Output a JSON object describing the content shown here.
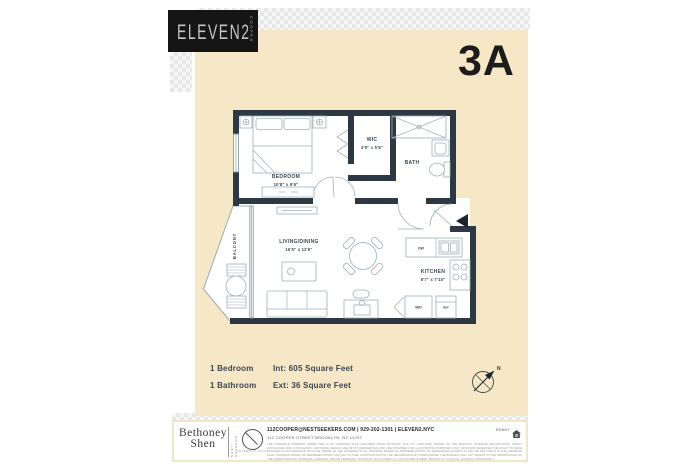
{
  "header": {
    "brand": "ELEVEN2",
    "brand_sub": "COOPER",
    "unit": "3A"
  },
  "floorplan": {
    "rooms": {
      "bedroom": {
        "name": "BEDROOM",
        "dims": "10'8\" x 9'6\""
      },
      "wic": {
        "name": "WIC",
        "dims": "3'9\" x 5'8\""
      },
      "bath": {
        "name": "BATH"
      },
      "living": {
        "name": "LIVING/DINING",
        "dims": "16'5\" x 12'6\""
      },
      "kitchen": {
        "name": "KITCHEN",
        "dims": "8'7\" x 7'10\""
      },
      "balcony": {
        "name": "BALCONY"
      }
    },
    "labels": {
      "dw": "DW",
      "wd": "W/D",
      "ref": "REF"
    },
    "compass_north": "N"
  },
  "summary": {
    "bedrooms": "1 Bedroom",
    "bathrooms": "1 Bathroom",
    "interior": "Int:  605 Square Feet",
    "exterior": "Ext:  36 Square Feet"
  },
  "footer": {
    "broker_line1": "Bethoney",
    "broker_line2": "Shen",
    "agency": "NEST SEEKERS",
    "agency_sub": "INTERNATIONAL",
    "contact": "112COOPER@NESTSEEKERS.COM   |   929-202-1301   |   ELEVEN2.NYC",
    "address": "112 COOPER STREET  BROOKLYN, NY 11207",
    "rebny": "REBNY",
    "disclaimer": "THE COMPLETE OFFERING TERMS ARE IN AN OFFERING PLAN AVAILABLE FROM SPONSOR. FILE NO. CD16-0348. IMAGES OF THE BUILDING, INTERIOR DECORATIONS, FINISH, APPLIANCES AND FURNISHINGS CONTAINED HEREIN ARE ARTIST RENDERINGS AND ARE PROVIDED FOR ILLUSTRATIVE PURPOSES ONLY. SPONSOR RESERVES THE RIGHT TO MAKE CHANGES IN ACCORDANCE WITH THE TERMS OF THE OFFERING PLAN. SPONSOR MAKES NO REPRESENTATION OR WARRANTIES EXCEPT AS MAY BE SET FORTH IN THE OFFERING PLAN. SPONSOR MAKES NO REPRESENTATION THAT ANY FUTURE CONSTRUCTION IN THE NEIGHBORHOOD SURROUNDING THE BUILDING WILL NOT RESULT IN THE OBSTRUCTION OF THE VIEWS FROM ANY WINDOWS, GARDENS, AND/OR TERRACES. SPONSOR: 112 COOPER LLC, 112 COOPER STREET, BROOKLYN, NY. EQUAL HOUSING OPPORTUNITY."
  },
  "colors": {
    "page_bg": "#f6e8c6",
    "wall": "#2c3844",
    "label_text": "#3b4752",
    "logo_bg": "#151515",
    "furniture_line": "#9fb0ba"
  }
}
